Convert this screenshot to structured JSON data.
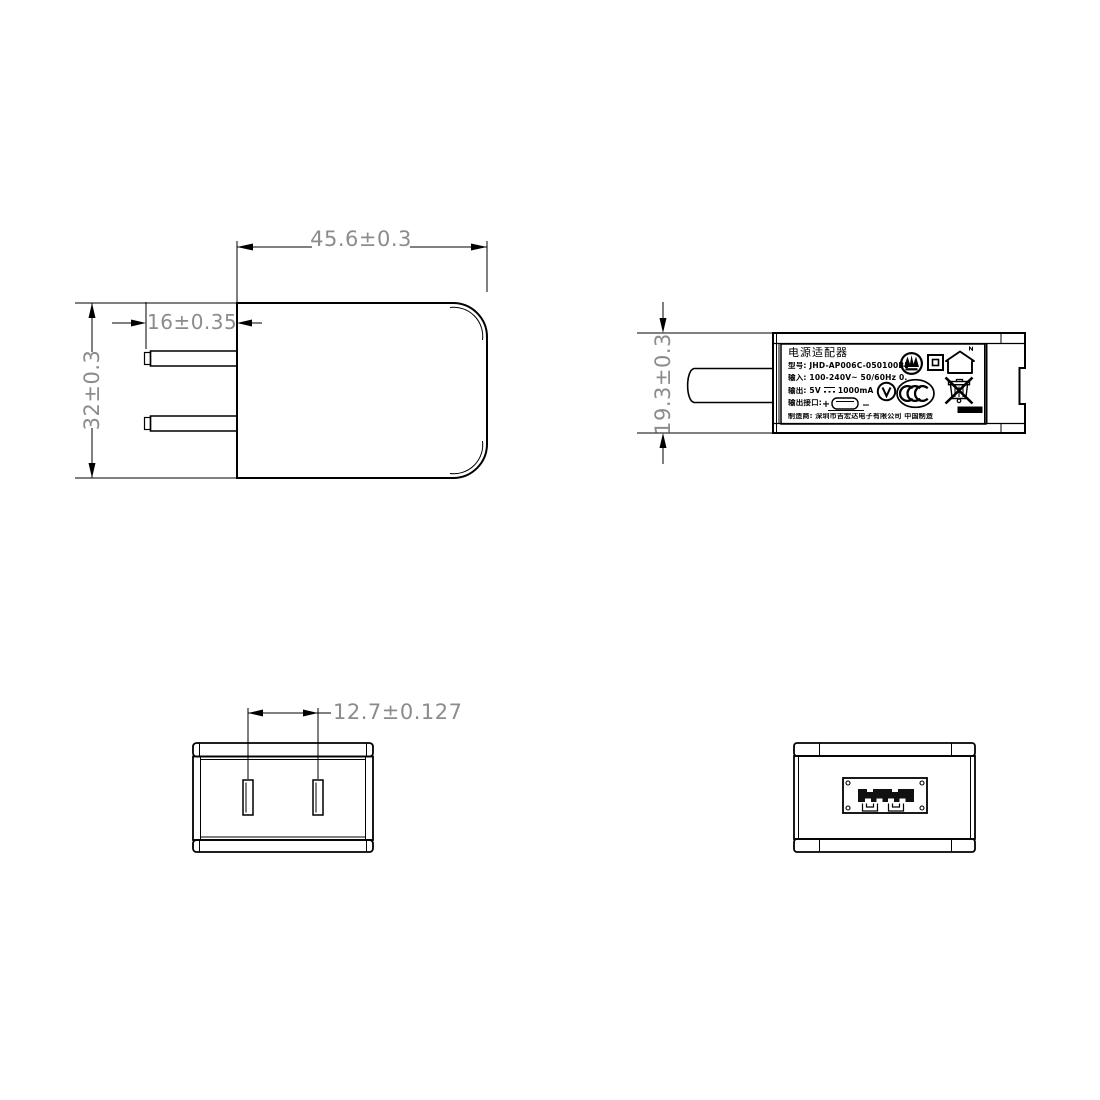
{
  "drawing": {
    "kind": "power-adapter-4-view-technical-drawing",
    "colors": {
      "line": "#000000",
      "dim_text": "#8c8c8c",
      "background": "#ffffff",
      "fill_black": "#111111"
    },
    "dimensions": {
      "front_width": "45.6±0.3",
      "prong_length": "16±0.35",
      "front_height": "32±0.3",
      "side_thickness": "19.3±0.3",
      "prong_spacing": "12.7±0.127"
    },
    "label": {
      "title": "电源适配器",
      "model": "型号: JHD-AP006C-050100BB-2",
      "input": "输入: 100-240V~  50/60Hz  0.2A",
      "output_prefix": "输出: 5V",
      "output_suffix": "1000mA",
      "port": "输出接口:",
      "port_plus": "+",
      "port_minus": "−",
      "maker": "制造商: 深圳市吉宏达电子有限公司   中国制造",
      "icons": [
        "certification-mark-icon",
        "class-ii-double-insulation-icon",
        "indoor-use-only-icon",
        "efficiency-level-v-icon",
        "ccc-mark-icon",
        "weee-bin-icon",
        "usb-connector-icon",
        "dc-symbol-icon"
      ]
    }
  }
}
